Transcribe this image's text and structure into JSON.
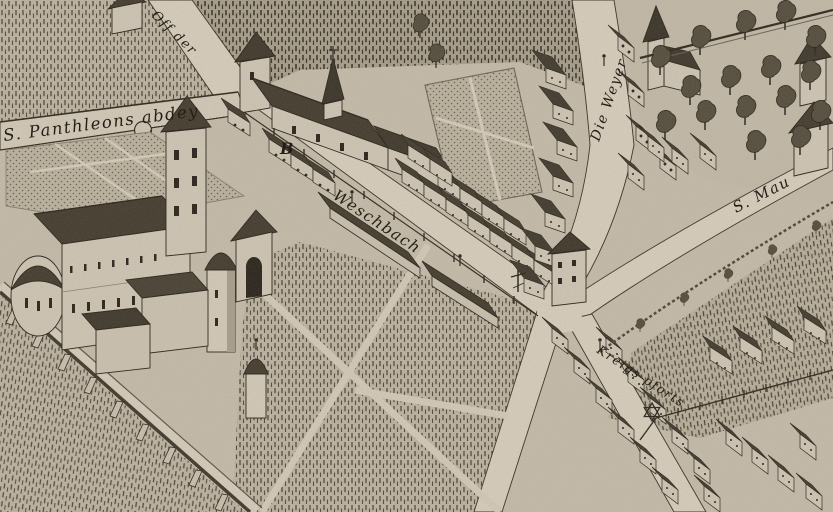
{
  "labels": {
    "abbey": "S. Panthleons abdey",
    "off_der": "Off der",
    "marker_b": "B",
    "weschbach": "Weschbach",
    "die_weyer": "Die Weyer",
    "s_mau": "S. Mau",
    "kreigs_pforts": "Kreigs pforts"
  },
  "icons": {
    "star": "six-pointed-star-icon",
    "cross": "wayside-cross-icon",
    "bastion": "round-bastion-icon"
  },
  "colors": {
    "paper": "#c5bbaa",
    "ink": "#332c22",
    "road": "#d7cdbc",
    "roof": "#453e31",
    "wall_light": "#cfc5b4"
  }
}
